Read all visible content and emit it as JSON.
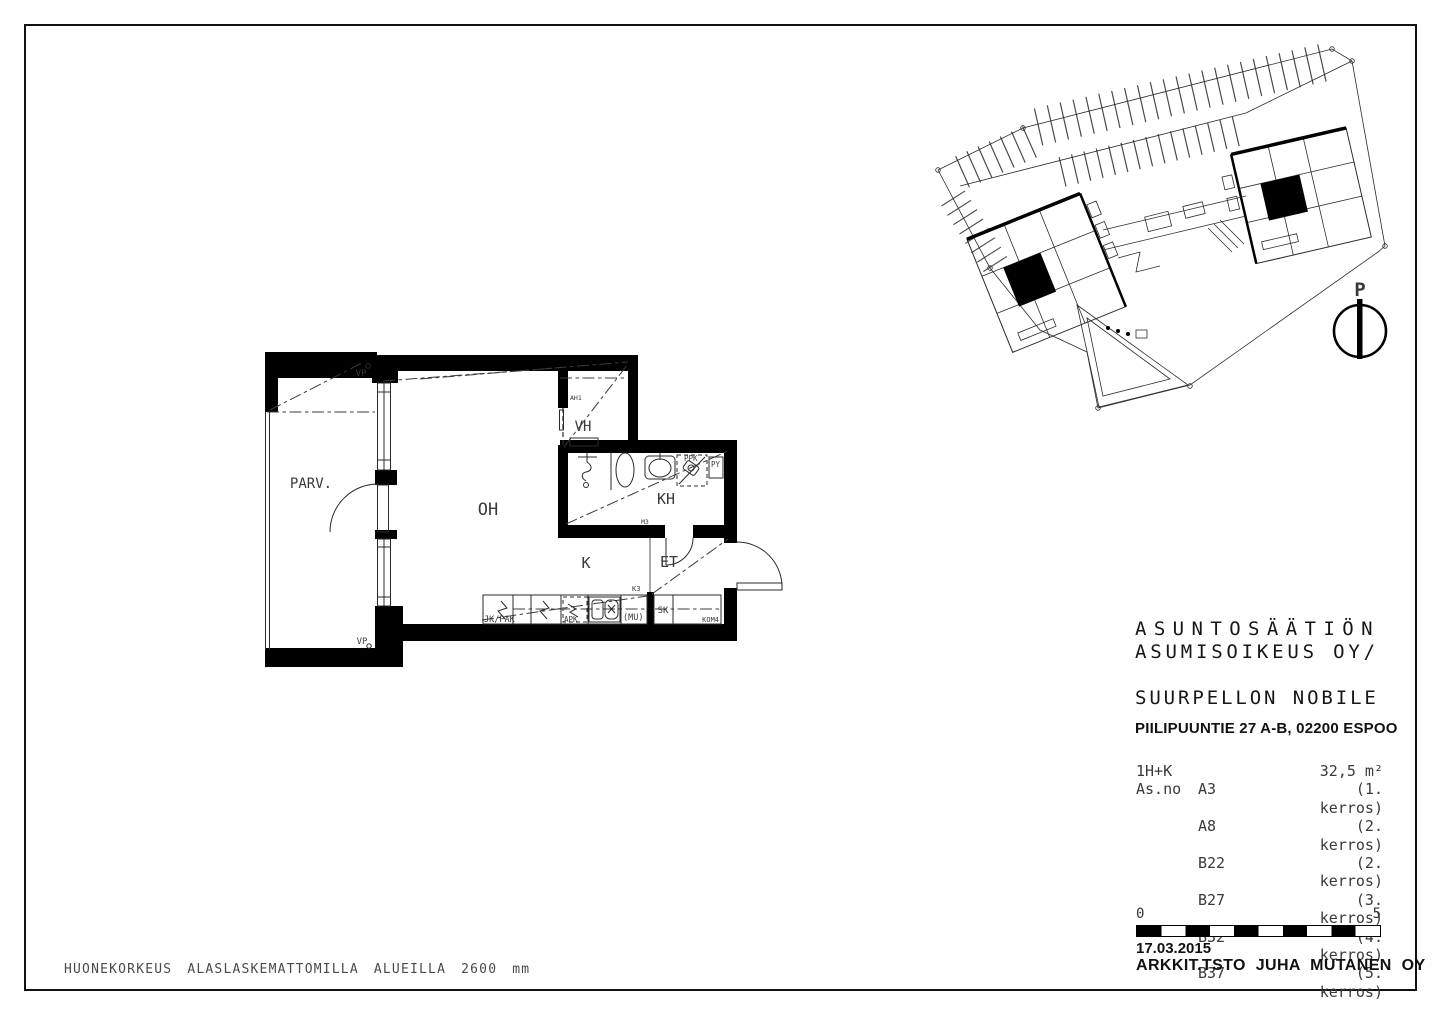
{
  "sheet": {
    "footer_note": "HUONEKORKEUS ALASLASKEMATTOMILLA ALUEILLA 2600 mm"
  },
  "site_plan": {
    "north_label": "P"
  },
  "floor_plan": {
    "rooms": {
      "balcony": "PARV.",
      "living": "OH",
      "kitchen": "K",
      "entry": "ET",
      "bathroom": "KH",
      "closet": "VH"
    },
    "markers": {
      "vp_top": "VP",
      "vp_bottom": "VP",
      "ah1": "AH1",
      "m3": "M3",
      "k3": "K3"
    },
    "fixtures": {
      "fridge_freezer": "JK/PAK",
      "dishwasher": "APK",
      "microwave": "(MU)",
      "cleaning_closet": "SK",
      "closet4": "KOM4",
      "washing_machine": "PPK",
      "laundry_cabinet": "PY"
    }
  },
  "title_block": {
    "org_line1": "ASUNTOSÄÄTIÖN",
    "org_line2": "ASUMISOIKEUS OY/",
    "project": "SUURPELLON NOBILE",
    "address": "PIILIPUUNTIE 27 A-B, 02200 ESPOO",
    "apartment_type": "1H+K",
    "area": "32,5 m²",
    "asno_label": "As.no",
    "units": [
      {
        "code": "A3",
        "floor": "(1. kerros)"
      },
      {
        "code": "A8",
        "floor": "(2. kerros)"
      },
      {
        "code": "B22",
        "floor": "(2. kerros)"
      },
      {
        "code": "B27",
        "floor": "(3. kerros)"
      },
      {
        "code": "B32",
        "floor": "(4. kerros)"
      },
      {
        "code": "B37",
        "floor": "(5. kerros)"
      }
    ],
    "scale": {
      "start": "0",
      "end": "5"
    },
    "date": "17.03.2015",
    "architect": "ARKKIT.TSTO JUHA MUTANEN OY"
  }
}
